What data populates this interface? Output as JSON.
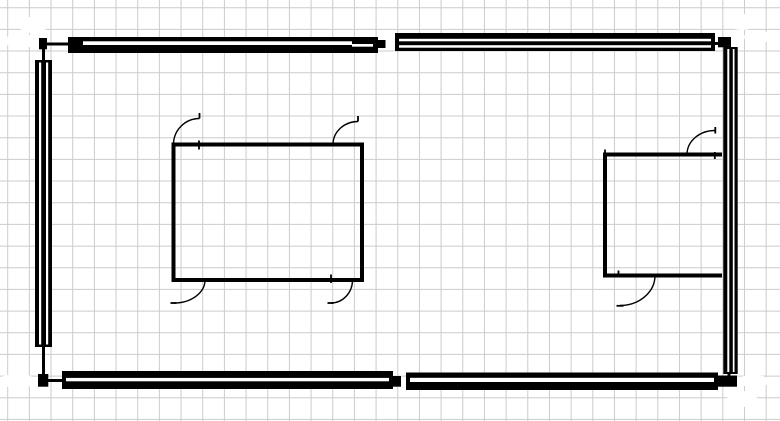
{
  "canvas": {
    "width": 780,
    "height": 421,
    "background": "#ffffff"
  },
  "grid": {
    "spacing": 21.67,
    "offset_x": 7.7,
    "offset_y": 7.7,
    "color": "#cccccc",
    "stroke_width": 1
  },
  "palette": {
    "ink": "#000000",
    "paper": "#ffffff"
  },
  "white_marks": [
    {
      "name": "whiteout-top-left-a",
      "cx": 33,
      "cy": 25,
      "rx": 15,
      "ry": 8
    },
    {
      "name": "whiteout-top-left-b",
      "cx": 21,
      "cy": 41,
      "rx": 17,
      "ry": 7
    },
    {
      "name": "whiteout-top-right-a",
      "cx": 742,
      "cy": 22,
      "rx": 15,
      "ry": 8
    },
    {
      "name": "whiteout-top-right-b",
      "cx": 757,
      "cy": 37,
      "rx": 13,
      "ry": 7
    },
    {
      "name": "whiteout-bottom-left",
      "cx": 17,
      "cy": 381,
      "rx": 19,
      "ry": 7
    },
    {
      "name": "whiteout-bottom-right-a",
      "cx": 753,
      "cy": 381,
      "rx": 17,
      "ry": 6
    },
    {
      "name": "whiteout-bottom-right-b",
      "cx": 742,
      "cy": 399,
      "rx": 15,
      "ry": 8
    }
  ],
  "walls": [
    {
      "name": "wall-top-left-segment",
      "rect": [
        68,
        37,
        310,
        16
      ],
      "stripes": [
        [
          83,
          41.3,
          269,
          3.7
        ],
        [
          352,
          44,
          21,
          2.7
        ]
      ]
    },
    {
      "name": "wall-top-right-segment",
      "rect": [
        395,
        33,
        320,
        18
      ],
      "stripes": [
        [
          399,
          38.8,
          312,
          2.5
        ],
        [
          399,
          45.2,
          312,
          2.5
        ]
      ]
    },
    {
      "name": "wall-bottom-left-segment",
      "rect": [
        62,
        371,
        331,
        18
      ],
      "stripes": [
        [
          66,
          377.9,
          323,
          3.4
        ]
      ]
    },
    {
      "name": "wall-bottom-right-segment",
      "rect": [
        406,
        372.5,
        312,
        17.5
      ],
      "stripes": [
        [
          410,
          377.8,
          304,
          4.2
        ]
      ]
    },
    {
      "name": "wall-left",
      "rect": [
        35,
        60,
        17,
        287
      ],
      "stripes": [
        [
          39,
          62.5,
          2.2,
          282
        ],
        [
          46,
          62.5,
          2.2,
          282
        ]
      ]
    },
    {
      "name": "wall-right",
      "rect": [
        723.3,
        47,
        14.4,
        327
      ],
      "stripes": [
        [
          727.3,
          49,
          2,
          323
        ],
        [
          732.8,
          49,
          1.7,
          323
        ]
      ]
    }
  ],
  "wall_joints": [
    {
      "name": "corner-cap-top-left",
      "rect": [
        39,
        38,
        8,
        11.3
      ]
    },
    {
      "name": "corner-cap-top-right",
      "rect": [
        718,
        37,
        13,
        10.3
      ]
    },
    {
      "name": "corner-cap-bottom-left",
      "rect": [
        38,
        374,
        10.3,
        12.7
      ]
    },
    {
      "name": "corner-cap-bottom-right",
      "rect": [
        718,
        375.5,
        19,
        11.2
      ]
    },
    {
      "name": "joint-top-wall",
      "rect": [
        377,
        40,
        8.5,
        8
      ]
    },
    {
      "name": "joint-bottom-wall",
      "rect": [
        393,
        376,
        8,
        10.7
      ]
    }
  ],
  "connector_lines": [
    {
      "name": "connector-top-left",
      "d": "M68,44 H43.5 V60",
      "w": 3
    },
    {
      "name": "connector-bottom-left",
      "d": "M43.5,347 V380.5 H62",
      "w": 3
    },
    {
      "name": "connector-top-right",
      "d": "M714,43.5 H729 V48",
      "w": 3
    },
    {
      "name": "connector-bottom-right",
      "d": "M729,374 V380 H718",
      "w": 3
    }
  ],
  "rooms": [
    {
      "name": "inner-room-left",
      "d": "M173.5,144.5 H362 V280 H173.5 Z",
      "w": 4
    },
    {
      "name": "inner-room-right",
      "d": "M722,154.5 H605 V275.5 H722",
      "w": 4
    }
  ],
  "doors": [
    {
      "name": "door-room-left-top-left",
      "arc": "M173.5,144.5 A26,26 0 0 1 199.5,118.5",
      "ticks": [
        "M199.5,118.5 V113",
        "M199,140.5 V149.5"
      ]
    },
    {
      "name": "door-room-left-top-right",
      "arc": "M333,144.5 A25,23 0 0 1 358,121.5",
      "ticks": [
        "M358,121.5 V116"
      ]
    },
    {
      "name": "door-room-left-bottom-left",
      "arc": "M205,280 A31,23 0 0 1 174,303",
      "ticks": [
        "M170.5,303 H176.5"
      ]
    },
    {
      "name": "door-room-left-bottom-right",
      "arc": "M352.5,280 A21.5,23 0 0 1 331,303",
      "ticks": [
        "M327.5,303 H333.5",
        "M331,274.5 V283"
      ]
    },
    {
      "name": "door-room-right-top",
      "arc": "M687,154.5 A28,24 0 0 1 715,130.5",
      "ticks": [
        "M715.3,127 V133.5",
        "M714.8,152 V159",
        "M605,149.5 V154.5"
      ]
    },
    {
      "name": "door-room-right-bottom",
      "arc": "M655,275.5 A35,30 0 0 1 620,305.5",
      "ticks": [
        "M616.5,305.8 H623.5",
        "M618.5,270.5 V276"
      ]
    }
  ],
  "door_stroke": 1.4
}
